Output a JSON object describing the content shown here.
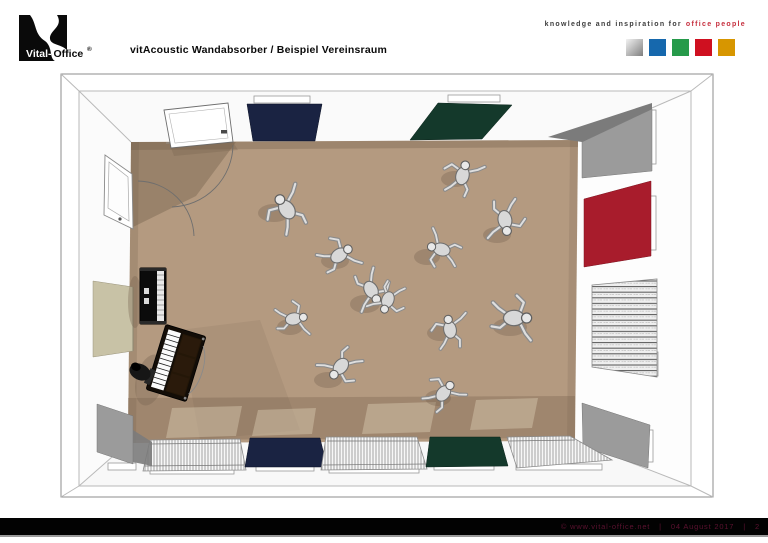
{
  "header": {
    "logo": {
      "brand_black": "Vital-",
      "brand_rest": "Office",
      "registered": "®"
    },
    "title": "vitAcoustic Wandabsorber / Beispiel Vereinsraum",
    "tagline": {
      "text": "knowledge and inspiration for",
      "highlight": "office people",
      "highlight_color": "#c62f3e"
    },
    "brand_squares": [
      {
        "name": "silver",
        "color": "#c6c6c6"
      },
      {
        "name": "blue",
        "color": "#1668ad"
      },
      {
        "name": "green",
        "color": "#269a4a"
      },
      {
        "name": "red",
        "color": "#cf1020"
      },
      {
        "name": "gold",
        "color": "#d79600"
      }
    ]
  },
  "scene": {
    "floor_color": "#b49a80",
    "panel_colors": {
      "navy": "#1a2342",
      "green": "#14392b",
      "red": "#a81c2c",
      "gray": "#9b9b9b",
      "gray_dark": "#7b7b7b",
      "beige": "#c8c2a6"
    }
  },
  "footer": {
    "copyright": "©  www.vital-office.net",
    "separator": "|",
    "date": "04 August 2017",
    "page": "2",
    "text_color": "#5c1230",
    "bar_color": "#000000"
  }
}
